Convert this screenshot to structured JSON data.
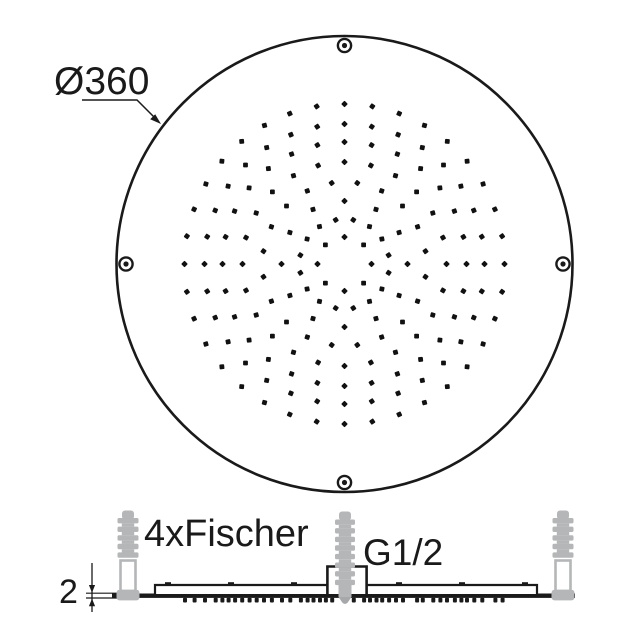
{
  "drawing": {
    "type": "technical-dimension-drawing",
    "subject": "round ceiling shower head",
    "line_color": "#1a1a1a",
    "anchor_color": "#b4b6b8",
    "anchor_tip_color": "#a6a8aa",
    "background": "#ffffff"
  },
  "labels": {
    "diameter": "Ø360",
    "anchors": "4xFischer",
    "thread": "G1/2",
    "thickness": "2"
  },
  "top_view": {
    "diameter_mm": 360,
    "center": {
      "x": 344.5,
      "y": 264
    },
    "outer_radius": 228,
    "screw_radius": 218.5,
    "screw_count": 4,
    "nozzle_dot_size": 4.8,
    "nozzle_rings": [
      {
        "r": 27,
        "count": 8,
        "offset": 0
      },
      {
        "r": 45,
        "count": 16,
        "offset": 11.25
      },
      {
        "r": 63,
        "count": 12,
        "offset": 0
      },
      {
        "r": 82,
        "count": 20,
        "offset": 9
      },
      {
        "r": 102,
        "count": 24,
        "offset": 0
      },
      {
        "r": 122,
        "count": 28,
        "offset": 0
      },
      {
        "r": 140,
        "count": 32,
        "offset": 0
      },
      {
        "r": 160,
        "count": 36,
        "offset": 0
      }
    ]
  },
  "side_view": {
    "plate_thickness_mm": 2,
    "connection_thread": "G1/2",
    "anchor_count": 4,
    "anchor_positions": [
      128,
      345,
      563
    ],
    "plate": {
      "left": 112,
      "right": 575,
      "top_y": 593.5,
      "bar_height": 4.4
    },
    "step": {
      "left": 155,
      "right": 537,
      "y": 585
    },
    "bump_positions": [
      168,
      231,
      294,
      399,
      462,
      525
    ]
  }
}
